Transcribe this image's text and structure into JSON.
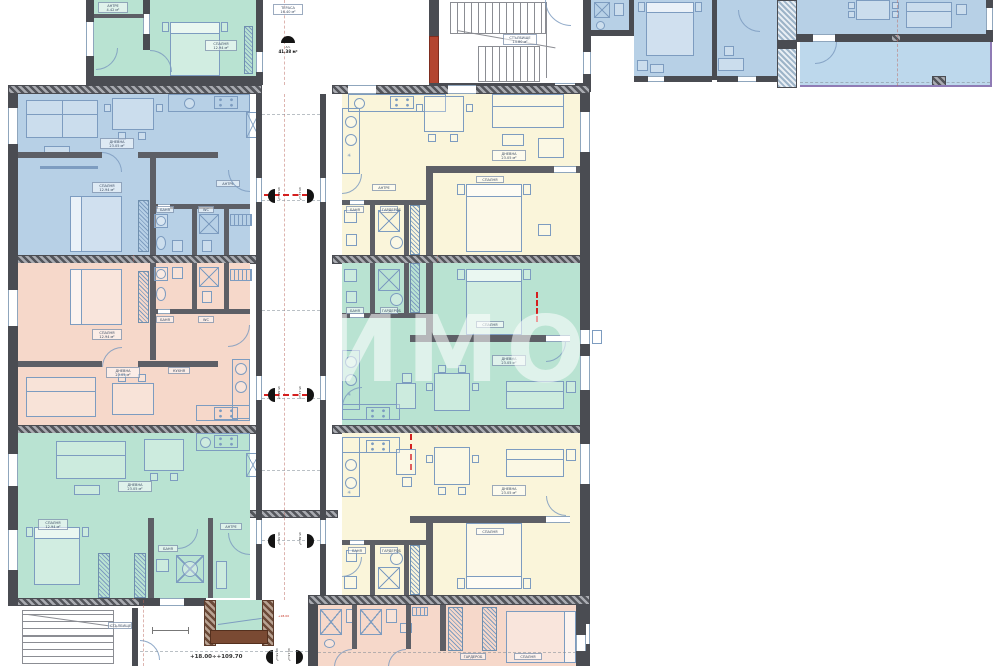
{
  "document": {
    "type": "architectural-floor-plan",
    "floor_note": "+18.00÷+109.70"
  },
  "colors": {
    "wall": "#4a4c52",
    "blue": "#b7d0e6",
    "pink": "#f6d8ca",
    "green": "#b9e3d2",
    "cream": "#faf5da",
    "terr": "#bdd8ec",
    "fur": "#7d9cc0",
    "redwall": "#b34530",
    "brown": "#7a4a33",
    "reddash": "#d41f1f",
    "terredge": "#8f7bb5"
  },
  "watermark": {
    "big": "ИМОТ",
    "small": "imot"
  },
  "top_marker": {
    "line1": "Ап.",
    "line2": "41.38 м²"
  },
  "entry_markers": [
    {
      "area": "43.84 м²"
    },
    {
      "area": "43.12 м²"
    },
    {
      "area": "45.64 м²"
    },
    {
      "area": "45.12 м²"
    },
    {
      "area": "46.36 м²"
    },
    {
      "area": "45.82 м²"
    },
    {
      "area": "44.58 м²"
    },
    {
      "area": "44.16 м²"
    }
  ],
  "note_red": "+18.00",
  "rooms": [
    {
      "name": "ДНЕВНА",
      "area": "23.05 м²"
    },
    {
      "name": "СПАЛНЯ",
      "area": "12.94 м²"
    },
    {
      "name": "БАНЯ",
      "area": "4.15 м²"
    },
    {
      "name": "WC",
      "area": "1.75 м²"
    },
    {
      "name": "КУХНЯ",
      "area": "9.80 м²"
    },
    {
      "name": "АНТРЕ",
      "area": "4.42 м²"
    },
    {
      "name": "СТЪЛБИЩЕ",
      "area": "14.80 м²"
    },
    {
      "name": "ГАРДЕРОБ",
      "area": "3.90 м²"
    },
    {
      "name": "ТЕРАСА",
      "area": "16.40 м²"
    },
    {
      "name": "КОРИДОР",
      "area": "5.60 м²"
    }
  ],
  "units": [
    {
      "id": "top-left-green",
      "color": "green"
    },
    {
      "id": "stairwell-top",
      "color": "white"
    },
    {
      "id": "top-right-blue",
      "color": "blue"
    },
    {
      "id": "left-blue",
      "color": "blue"
    },
    {
      "id": "left-pink",
      "color": "pink"
    },
    {
      "id": "left-green",
      "color": "green"
    },
    {
      "id": "right-yellow-1",
      "color": "cream"
    },
    {
      "id": "right-green",
      "color": "green"
    },
    {
      "id": "right-yellow-2",
      "color": "cream"
    },
    {
      "id": "bottom-pink",
      "color": "pink"
    },
    {
      "id": "stairwell-bottom",
      "color": "white"
    }
  ]
}
